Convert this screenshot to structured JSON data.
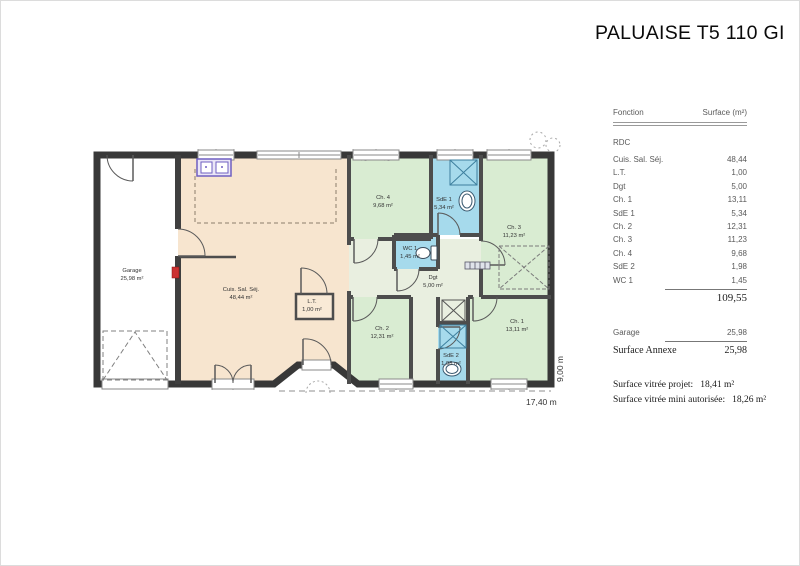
{
  "title": "PALUAISE T5 110 GI",
  "table": {
    "col_function": "Fonction",
    "col_surface": "Surface (m²)",
    "section": "RDC",
    "rows": [
      {
        "label": "Cuis. Sal. Séj.",
        "value": "48,44"
      },
      {
        "label": "L.T.",
        "value": "1,00"
      },
      {
        "label": "Dgt",
        "value": "5,00"
      },
      {
        "label": "Ch. 1",
        "value": "13,11"
      },
      {
        "label": "SdE 1",
        "value": "5,34"
      },
      {
        "label": "Ch. 2",
        "value": "12,31"
      },
      {
        "label": "Ch. 3",
        "value": "11,23"
      },
      {
        "label": "Ch. 4",
        "value": "9,68"
      },
      {
        "label": "SdE 2",
        "value": "1,98"
      },
      {
        "label": "WC 1",
        "value": "1,45"
      }
    ],
    "total": "109,55",
    "garage_row": {
      "label": "Garage",
      "value": "25,98"
    },
    "annexe_row": {
      "label": "Surface Annexe",
      "value": "25,98"
    }
  },
  "notes": {
    "line1_label": "Surface vitrée projet:",
    "line1_value": "18,41 m²",
    "line2_label": "Surface vitrée mini autorisée:",
    "line2_value": "18,26 m²"
  },
  "plan": {
    "dim_width": "17,40 m",
    "dim_height": "9,00 m",
    "rooms": [
      {
        "name": "Garage",
        "area": "25,98 m²"
      },
      {
        "name": "Cuis. Sal. Séj.",
        "area": "48,44 m²"
      },
      {
        "name": "L.T.",
        "area": "1,00 m²"
      },
      {
        "name": "Ch. 4",
        "area": "9,68 m²"
      },
      {
        "name": "SdE 1",
        "area": "5,34 m²"
      },
      {
        "name": "Ch. 3",
        "area": "11,23 m²"
      },
      {
        "name": "WC 1",
        "area": "1,45 m²"
      },
      {
        "name": "Dgt",
        "area": "5,00 m²"
      },
      {
        "name": "Ch. 2",
        "area": "12,31 m²"
      },
      {
        "name": "SdE 2",
        "area": "1,98 m²"
      },
      {
        "name": "Ch. 1",
        "area": "13,11 m²"
      }
    ],
    "colors": {
      "bedroom": "#d9ecd2",
      "bathroom": "#a6daec",
      "living": "#f7e5cf",
      "hall": "#e9efe0",
      "wall": "#3b3b3b",
      "panel_red": "#cc3333",
      "kitchen_purple": "#6f5fc0"
    }
  }
}
